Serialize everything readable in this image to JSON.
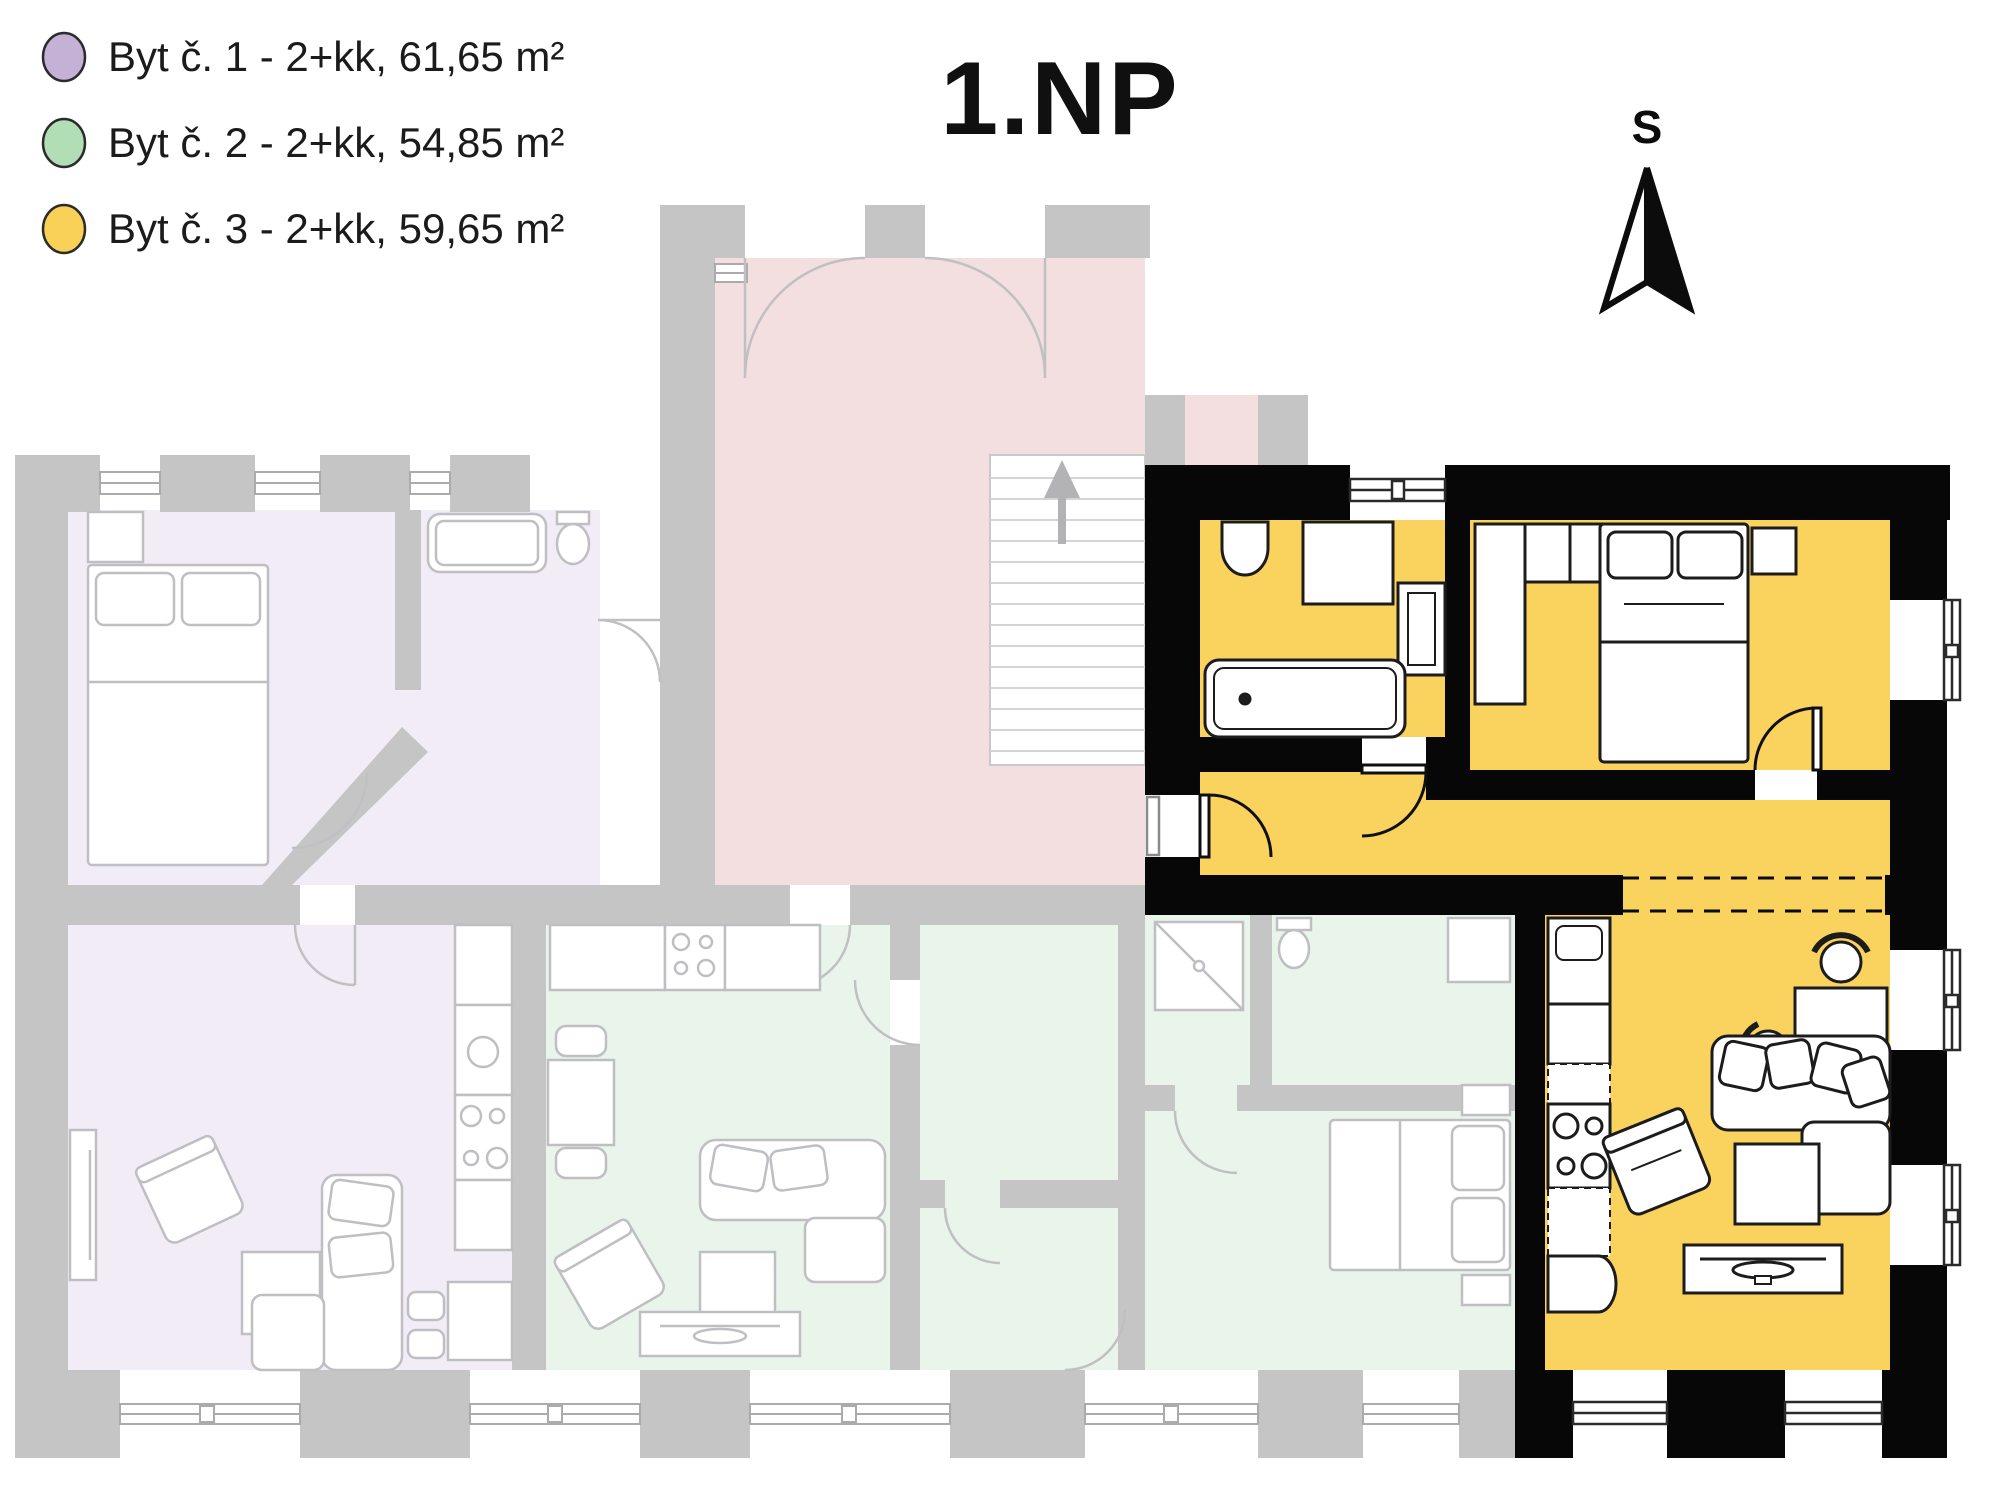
{
  "header": {
    "title": "1.NP"
  },
  "compass": {
    "letter": "S",
    "icon": "north-arrow-icon"
  },
  "legend": {
    "items": [
      {
        "label": "Byt č. 1 - 2+kk, 61,65 m²",
        "apartment": "Byt č. 1",
        "layout": "2+kk",
        "area_m2": "61,65",
        "color": "#c6b1d6"
      },
      {
        "label": "Byt č. 2 - 2+kk, 54,85 m²",
        "apartment": "Byt č. 2",
        "layout": "2+kk",
        "area_m2": "54,85",
        "color": "#b2deb6"
      },
      {
        "label": "Byt č. 3 - 2+kk, 59,65 m²",
        "apartment": "Byt č. 3",
        "layout": "2+kk",
        "area_m2": "59,65",
        "color": "#f9d157"
      }
    ]
  },
  "floor_plan": {
    "floor": "1.NP",
    "highlighted_apartment": "Byt č. 3",
    "colors": {
      "apartment1_floor": "#f1ecf6",
      "apartment2_floor": "#e9f4eb",
      "apartment3_floor": "#fad35e",
      "common_area_floor": "#f3dfdf",
      "faded_walls": "#c5c5c6",
      "highlight_walls": "#070707",
      "faded_lines": "#bfbfc3",
      "stair_lines": "#d4d4d6"
    }
  }
}
